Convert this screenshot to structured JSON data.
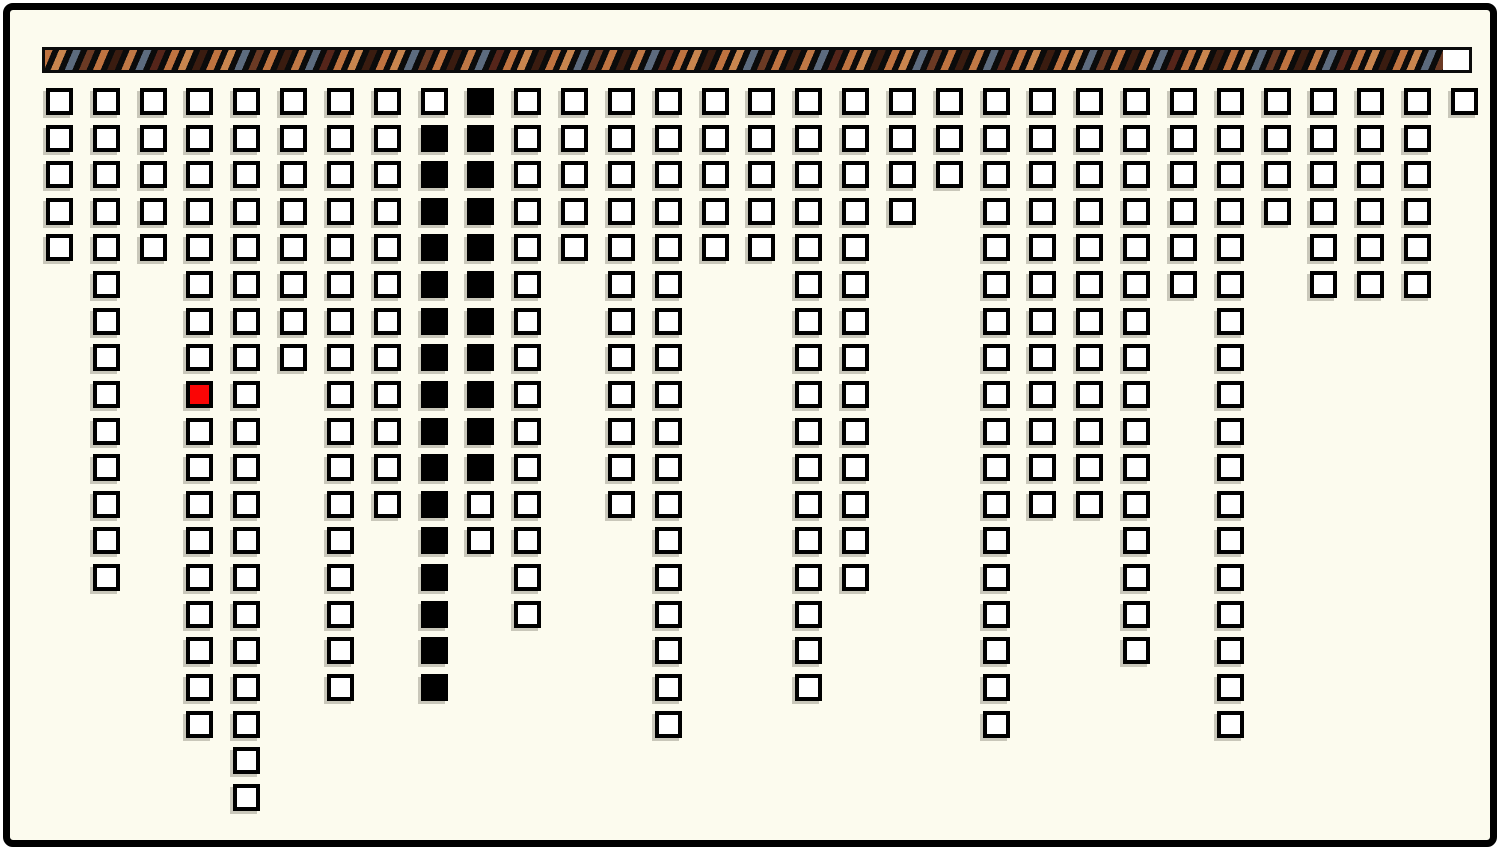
{
  "window": {
    "background_color": "#FCFBEE",
    "frame_color": "#000000"
  },
  "progress_bar": {
    "fill_fraction": 0.982,
    "bar_background_color": "#0b0b0b",
    "empty_color": "#ffffff",
    "stripe_colors": [
      "#BF7340",
      "#C8854E",
      "#5C6B7E",
      "#6B3A24",
      "#BF7340",
      "#3A1C10",
      "#C07845",
      "#5C6B7E",
      "#55251A",
      "#BF7340",
      "#C8854E",
      "#3A1C10"
    ]
  },
  "grid": {
    "num_columns": 31,
    "max_rows": 20,
    "cell_colors": {
      "empty": "#ffffff",
      "filled": "#000000",
      "selected": "#fb0505",
      "border": "#000000",
      "shadow": "#c9c7ba"
    },
    "columns": [
      {
        "height": 5
      },
      {
        "height": 14
      },
      {
        "height": 5
      },
      {
        "height": 18,
        "red_rows": [
          9
        ]
      },
      {
        "height": 20
      },
      {
        "height": 8
      },
      {
        "height": 17
      },
      {
        "height": 12
      },
      {
        "height": 17,
        "black_rows": [
          2,
          17
        ]
      },
      {
        "height": 13,
        "black_rows": [
          1,
          11
        ]
      },
      {
        "height": 15
      },
      {
        "height": 5
      },
      {
        "height": 12
      },
      {
        "height": 18
      },
      {
        "height": 5
      },
      {
        "height": 5
      },
      {
        "height": 17
      },
      {
        "height": 14
      },
      {
        "height": 4
      },
      {
        "height": 3
      },
      {
        "height": 18
      },
      {
        "height": 12
      },
      {
        "height": 12
      },
      {
        "height": 16
      },
      {
        "height": 6
      },
      {
        "height": 18
      },
      {
        "height": 4
      },
      {
        "height": 6
      },
      {
        "height": 6
      },
      {
        "height": 6
      },
      {
        "height": 1
      }
    ]
  }
}
